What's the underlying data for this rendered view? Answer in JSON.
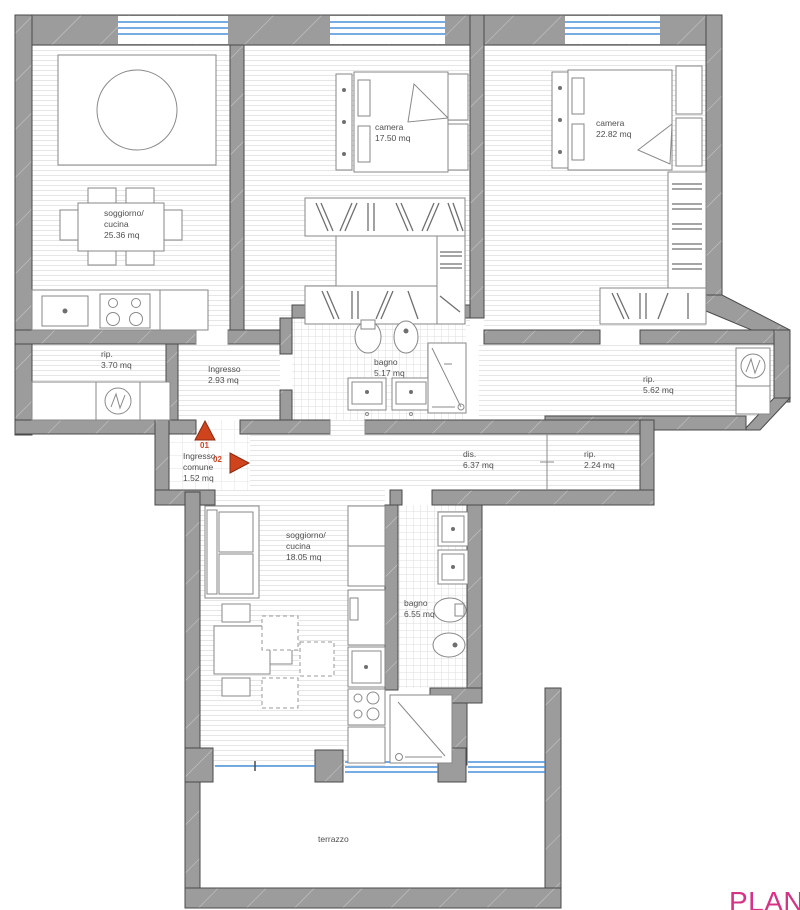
{
  "plan": {
    "title": "apartment floor plan",
    "watermark": "PLANIM",
    "colors": {
      "wall_gray": "#9c9c9c",
      "wall_outline": "#4a4a4a",
      "window_blue": "#4a90d9",
      "marker_orange": "#cf431d",
      "label_gray": "#4f4f4f",
      "watermark_pink": "#d63384"
    },
    "icons": {
      "washing_machine": "circle-zigzag",
      "entry_marker_up": "triangle-up",
      "entry_marker_right": "triangle-right"
    },
    "labels": {
      "soggiorno_upper": {
        "l1": "soggiorno/",
        "l2": "cucina",
        "l3": "25.36 mq"
      },
      "camera1": {
        "l1": "camera",
        "l2": "17.50 mq"
      },
      "camera2": {
        "l1": "camera",
        "l2": "22.82 mq"
      },
      "rip1": {
        "l1": "rip.",
        "l2": "3.70 mq"
      },
      "ingresso": {
        "l1": "Ingresso",
        "l2": "2.93 mq"
      },
      "bagno1": {
        "l1": "bagno",
        "l2": "5.17 mq"
      },
      "rip2": {
        "l1": "rip.",
        "l2": "5.62 mq"
      },
      "ingresso_comune": {
        "l1": "Ingresso",
        "l2": "comune",
        "l3": "1.52 mq"
      },
      "dis": {
        "l1": "dis.",
        "l2": "6.37 mq"
      },
      "rip3": {
        "l1": "rip.",
        "l2": "2.24 mq"
      },
      "soggiorno_lower": {
        "l1": "soggiorno/",
        "l2": "cucina",
        "l3": "18.05 mq"
      },
      "bagno2": {
        "l1": "bagno",
        "l2": "6.55 mq"
      },
      "terrazzo": {
        "l1": "terrazzo"
      }
    },
    "markers": {
      "m1": "01",
      "m2": "02"
    }
  }
}
